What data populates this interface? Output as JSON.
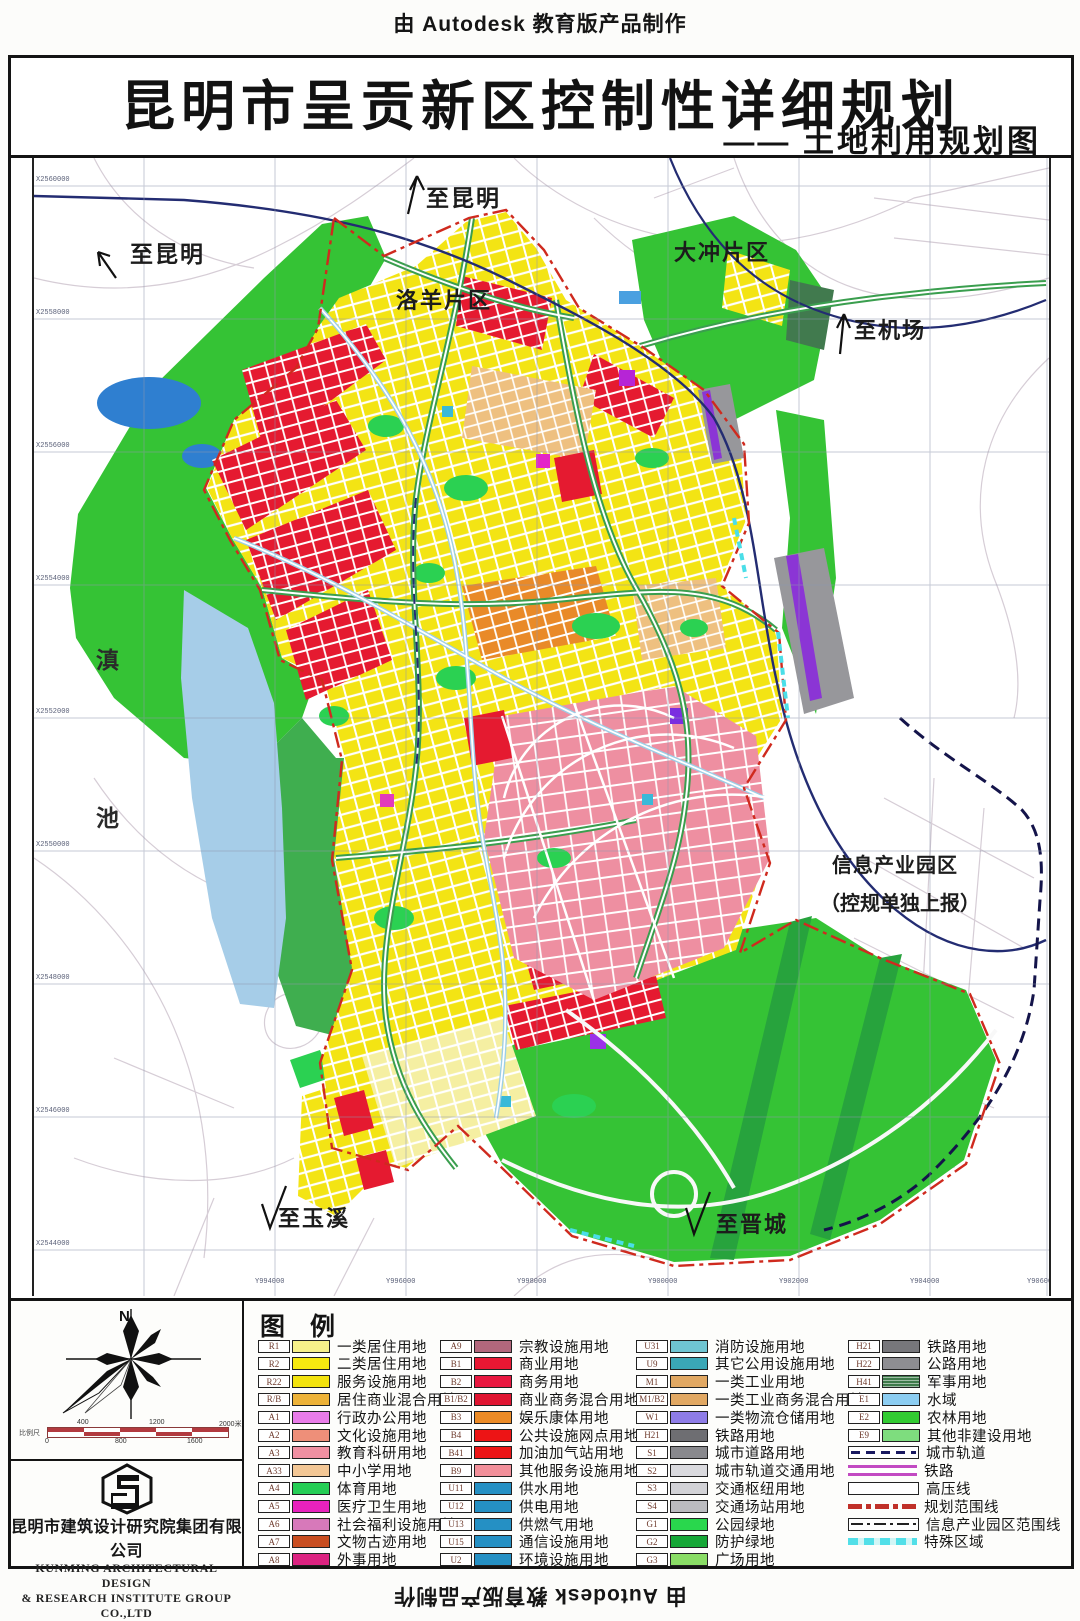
{
  "page": {
    "top_credit": "由 Autodesk 教育版产品制作",
    "bottom_credit": "由 Autodesk 教育版产品制作",
    "left_credit": "由 Autodesk 教育版产品制作",
    "right_credit": "由 Autodesk 教育版产品制作"
  },
  "title": {
    "main": "昆明市呈贡新区控制性详细规划",
    "sub": "—— 土地利用规划图"
  },
  "map": {
    "labels": {
      "to_kunming_top": "至昆明",
      "to_kunming_left": "至昆明",
      "dachong": "大冲片区",
      "luoyang": "洛羊片区",
      "to_airport": "至机场",
      "dianchi_char1": "滇",
      "dianchi_char2": "池",
      "info_park_line1": "信息产业园区",
      "info_park_line2": "（控规单独上报）",
      "to_yuxi": "至玉溪",
      "to_jincheng": "至晋城"
    },
    "x_axis": [
      "Y994000",
      "Y996000",
      "Y998000",
      "Y900000",
      "Y902000",
      "Y904000",
      "Y906000"
    ],
    "y_axis": [
      "X2560000",
      "X2558000",
      "X2556000",
      "X2554000",
      "X2552000",
      "X2550000",
      "X2548000",
      "X2546000",
      "X2544000"
    ]
  },
  "legend": {
    "header": "图    例",
    "columns": [
      [
        {
          "code": "R1",
          "color": "#f7f18a",
          "label": "一类居住用地"
        },
        {
          "code": "R2",
          "color": "#f7ea10",
          "label": "二类居住用地"
        },
        {
          "code": "R22",
          "color": "#f3e30e",
          "label": "服务设施用地"
        },
        {
          "code": "R/B",
          "color": "#edb238",
          "label": "居住商业混合用地"
        },
        {
          "code": "A1",
          "color": "#e97ce9",
          "label": "行政办公用地"
        },
        {
          "code": "A2",
          "color": "#ee8f79",
          "label": "文化设施用地"
        },
        {
          "code": "A3",
          "color": "#f090a2",
          "label": "教育科研用地"
        },
        {
          "code": "A33",
          "color": "#f3c795",
          "label": "中小学用地"
        },
        {
          "code": "A4",
          "color": "#25ce55",
          "label": "体育用地"
        },
        {
          "code": "A5",
          "color": "#e822bd",
          "label": "医疗卫生用地"
        },
        {
          "code": "A6",
          "color": "#d779ba",
          "label": "社会福利设施用地"
        },
        {
          "code": "A7",
          "color": "#c94e20",
          "label": "文物古迹用地"
        },
        {
          "code": "A8",
          "color": "#dc2381",
          "label": "外事用地"
        }
      ],
      [
        {
          "code": "A9",
          "color": "#b2677c",
          "label": "宗教设施用地"
        },
        {
          "code": "B1",
          "color": "#e91733",
          "label": "商业用地"
        },
        {
          "code": "B2",
          "color": "#e9173f",
          "label": "商务用地"
        },
        {
          "code": "B1/B2",
          "color": "#df1430",
          "label": "商业商务混合用地"
        },
        {
          "code": "B3",
          "color": "#ec8b26",
          "label": "娱乐康体用地"
        },
        {
          "code": "B4",
          "color": "#ed1415",
          "label": "公共设施网点用地"
        },
        {
          "code": "B41",
          "color": "#ed1415",
          "label": "加油加气站用地"
        },
        {
          "code": "B9",
          "color": "#f28f99",
          "label": "其他服务设施用地"
        },
        {
          "code": "U11",
          "color": "#2590c4",
          "label": "供水用地"
        },
        {
          "code": "U12",
          "color": "#2590c4",
          "label": "供电用地"
        },
        {
          "code": "U13",
          "color": "#2590c4",
          "label": "供燃气用地"
        },
        {
          "code": "U15",
          "color": "#2590c4",
          "label": "通信设施用地"
        },
        {
          "code": "U2",
          "color": "#2590c4",
          "label": "环境设施用地"
        }
      ],
      [
        {
          "code": "U31",
          "color": "#6fc5d2",
          "label": "消防设施用地"
        },
        {
          "code": "U9",
          "color": "#3aa7b6",
          "label": "其它公用设施用地"
        },
        {
          "code": "M1",
          "color": "#e1a863",
          "label": "一类工业用地"
        },
        {
          "code": "M1/B2",
          "color": "#e1a863",
          "label": "一类工业商务混合用地"
        },
        {
          "code": "W1",
          "color": "#8e7ce7",
          "label": "一类物流仓储用地"
        },
        {
          "code": "H21",
          "color": "#6e6e72",
          "label": "铁路用地"
        },
        {
          "code": "S1",
          "color": "#89898d",
          "label": "城市道路用地"
        },
        {
          "code": "S2",
          "color": "#dadade",
          "label": "城市轨道交通用地"
        },
        {
          "code": "S3",
          "color": "#d2d2d6",
          "label": "交通枢纽用地"
        },
        {
          "code": "S4",
          "color": "#bbbbbf",
          "label": "交通场站用地"
        },
        {
          "code": "G1",
          "color": "#29d74d",
          "label": "公园绿地"
        },
        {
          "code": "G2",
          "color": "#16a737",
          "label": "防护绿地"
        },
        {
          "code": "G3",
          "color": "#8add66",
          "label": "广场用地"
        }
      ],
      [
        {
          "code": "H21",
          "color": "#77777b",
          "label": "铁路用地"
        },
        {
          "code": "H22",
          "color": "#8e8e92",
          "label": "公路用地"
        },
        {
          "code": "H41",
          "color": "#3e7a4a",
          "label": "军事用地",
          "stripes": true
        },
        {
          "code": "E1",
          "color": "#8ccdf1",
          "label": "水域"
        },
        {
          "code": "E2",
          "color": "#32cb32",
          "label": "农林用地"
        },
        {
          "code": "E9",
          "color": "#7edd7e",
          "label": "其他非建设用地"
        },
        {
          "symbol": "subway",
          "label": "城市轨道"
        },
        {
          "symbol": "railline",
          "label": "铁路"
        },
        {
          "symbol": "hvline",
          "label": "高压线"
        },
        {
          "symbol": "redline",
          "label": "规划范围线"
        },
        {
          "symbol": "infoline",
          "label": "信息产业园区范围线"
        },
        {
          "symbol": "special",
          "label": "特殊区域"
        }
      ]
    ]
  },
  "compass": {
    "north_label": "N"
  },
  "scalebar": {
    "label": "比例尺",
    "top_ticks": [
      "400",
      "1200",
      "2000米"
    ],
    "bottom_ticks": [
      "0",
      "800",
      "1600"
    ]
  },
  "publisher": {
    "cn": "昆明市建筑设计研究院集团有限公司",
    "en1": "KUNMING ARCHITECTURAL DESIGN",
    "en2": "& RESEARCH INSTITUTE GROUP CO.,LTD"
  },
  "palette": {
    "farmland_green": "#35c335",
    "park_green": "#2bd152",
    "protect_green": "#27a33d",
    "urban_yellow": "#f3e414",
    "commercial_red": "#e51a30",
    "education_pink": "#ee8fa1",
    "water_blue": "#a6cde8",
    "planning_boundary_red": "#cf2a1e",
    "rail_navy": "#232c72",
    "grid_gray": "#8f97ad"
  }
}
